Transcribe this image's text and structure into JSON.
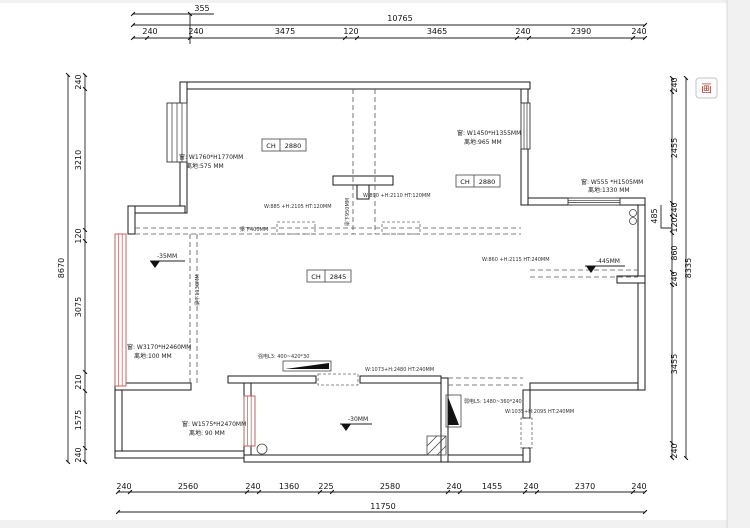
{
  "canvas": {
    "tool_button_glyph": "画"
  },
  "dimensions": {
    "top": {
      "offset": "355",
      "overall": "10765",
      "segments": [
        "240",
        "240",
        "3475",
        "120",
        "3465",
        "240",
        "2390",
        "240"
      ]
    },
    "left": {
      "overall": "8670",
      "segments": [
        "240",
        "3210",
        "120",
        "3075",
        "210",
        "1575",
        "240"
      ]
    },
    "right": {
      "overall": "8335",
      "offset": "485",
      "segments": [
        "240",
        "2455",
        "240",
        "120",
        "860",
        "240",
        "3455",
        "240"
      ]
    },
    "bottom": {
      "overall": "11750",
      "segments": [
        "240",
        "2560",
        "240",
        "1360",
        "225",
        "2580",
        "240",
        "1455",
        "240",
        "2370",
        "240"
      ]
    }
  },
  "ceiling": [
    {
      "label": "CH",
      "value": "2880"
    },
    {
      "label": "CH",
      "value": "2880"
    },
    {
      "label": "CH",
      "value": "2845"
    }
  ],
  "windows": [
    {
      "size": "窗: W1760*H1770MM",
      "sill": "离地:575 MM"
    },
    {
      "size": "窗: W1450*H1355MM",
      "sill": "离地:965 MM"
    },
    {
      "size": "窗: W555 *H1505MM",
      "sill": "离地:1330 MM"
    },
    {
      "size": "窗: W3170*H2460MM",
      "sill": "离地:100 MM"
    },
    {
      "size": "窗: W1575*H2470MM",
      "sill": "离地: 90 MM"
    }
  ],
  "doors": [
    "W:885 +H:2105 HT:120MM",
    "W:890 +H:2110 HT:120MM",
    "W:860 +H:2115 HT:240MM",
    "W:1073+H:2480 HT:240MM",
    "W:1035+H:2095 HT:240MM"
  ],
  "levels": [
    "-35MM",
    "-445MM",
    "-30MM"
  ],
  "beams": [
    "梁下1130MM",
    "梁下400MM",
    "梁下950MM"
  ],
  "electrical": [
    "强电L3: 400~420*30",
    "弱电L5: 1480~360*240"
  ]
}
